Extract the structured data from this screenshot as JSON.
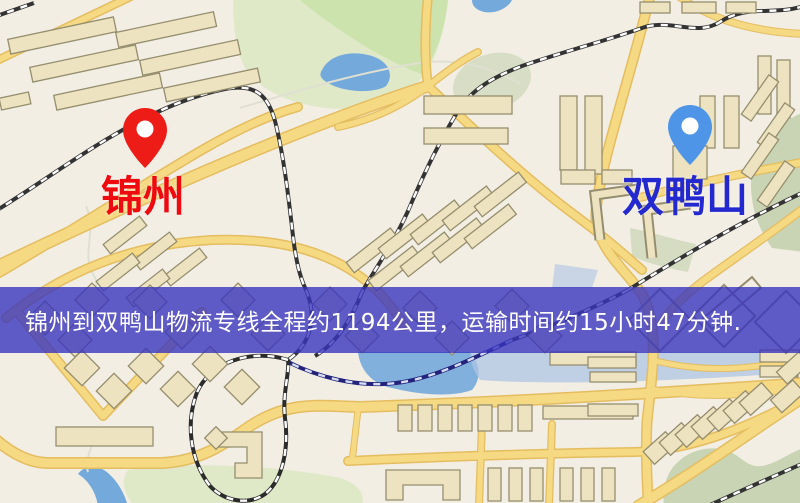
{
  "map": {
    "origin_marker": {
      "label": "锦州",
      "pin_icon": "red-location-pin"
    },
    "destination_marker": {
      "label": "双鸭山",
      "pin_icon": "blue-location-pin"
    },
    "banner": {
      "text": "锦州到双鸭山物流专线全程约1194公里，运输时间约15小时47分钟."
    }
  },
  "colors": {
    "map-bg": "#f3eee4",
    "road-fill": "#f5d983",
    "road-edge": "#e4bd60",
    "rail-dark": "#333333",
    "rail-navy": "#23237c",
    "building-fill": "#eee3c0",
    "building-stroke": "#958e6e",
    "park": "#dfe9c8",
    "park-bright": "#cde3ae",
    "sage": "#c9d4b4",
    "water": "#74a9dc",
    "water-pale": "#aec4e4",
    "origin-label": "#ee0a0e",
    "origin-pin": "#ed1c16",
    "destination-label": "#2429cf",
    "destination-pin": "#4e95e8",
    "banner-bg": "rgba(56,52,190,0.8)",
    "banner-text": "#ffffff"
  }
}
